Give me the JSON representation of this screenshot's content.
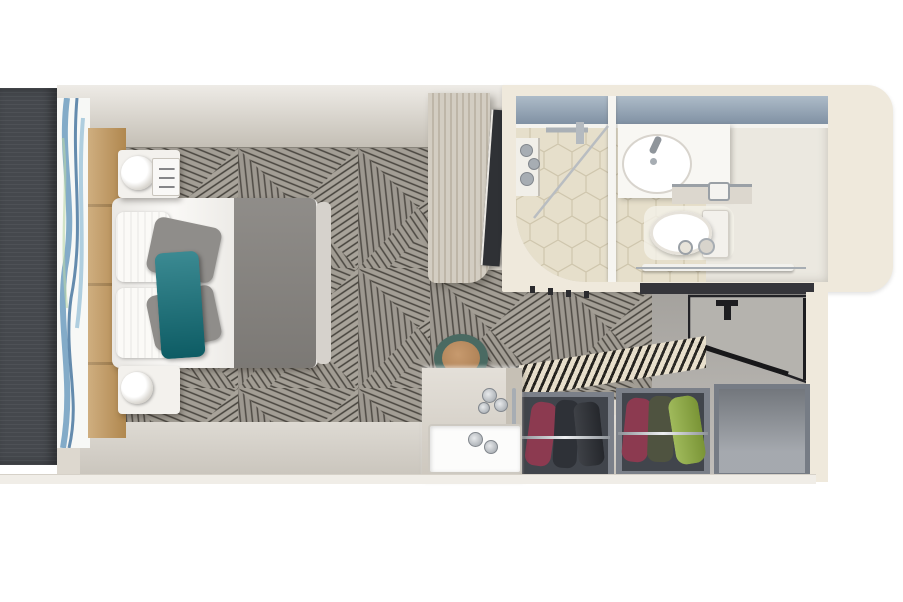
{
  "scene": {
    "type": "3d-floorplan-top-view",
    "description": "Top-down 3D rendering of a cruise-ship cabin stateroom floor plan",
    "areas": [
      "bedroom",
      "bathroom",
      "entry-hall",
      "wardrobe"
    ],
    "items": [
      "balcony-door",
      "curtain",
      "headboard",
      "double-bed",
      "duvet",
      "bed-runner",
      "pillows-white",
      "pillows-gray",
      "pillow-teal",
      "nightstand-top",
      "nightstand-bottom",
      "table-lamp",
      "tv-panel",
      "wall-tv",
      "shower",
      "toiletry-shelf",
      "sink",
      "faucet",
      "toilet",
      "toilet-paper-holder",
      "towel-rail",
      "entrance-door",
      "door-handle",
      "coat-hook",
      "open-wardrobe",
      "hanging-clothes",
      "luggage-compartment",
      "vanity-desk",
      "vanity-tray",
      "perfume-bottles",
      "round-stool",
      "carpet"
    ]
  },
  "palette": {
    "background": "#ffffff",
    "wall_cream": "#efe9dc",
    "wall_divider": "#f3efe7",
    "top_wall": "#d9d3c8",
    "floor_light": "#d6d1c8",
    "floor_base": "#ddd8cf",
    "carpet_base": "#a39e95",
    "balcony_panel": "#45484d",
    "curtain_white": "#f7f8f6",
    "curtain_blue": "#6f9ec0",
    "headboard_tan": "#bf9355",
    "duvet_white": "#f6f4f0",
    "runner_gray": "#86837f",
    "footboard": "#d6d2cc",
    "pillow_white": "#fbfaf7",
    "pillow_gray": "#8f8d8a",
    "pillow_teal": "#10707a",
    "nightstand": "#f3f1ed",
    "wood_panel": "#c9c2b4",
    "tv_dark": "#2f3135",
    "counter_blue": "#92a5b6",
    "hex_tile": "#e6dfcb",
    "bath_floor": "#ebe8e0",
    "porcelain": "#ffffff",
    "tank_white": "#f3f1ec",
    "counter_white": "#f8f7f3",
    "chrome": "#a7adb3",
    "dark_ledge": "#35353a",
    "entry_floor": "#b7b4af",
    "door_gray": "#b5b3ae",
    "door_black": "#1d1d20",
    "closet_gray": "#7b8089",
    "closet_interior": "#41454c",
    "empty_shelf": "#8c9198",
    "cloth_maroon": "#8c3a50",
    "cloth_dark": "#2e3137",
    "cloth_olive": "#4f5340",
    "cloth_green": "#8fae3f",
    "stool_teal": "#4a6a62",
    "stool_leather": "#b98d64",
    "desk_wood": "#d8d2c8",
    "desk_side": "#c6c0b5",
    "tray_white": "#fcfcfb",
    "bottom_wall": "#f0ede7"
  }
}
